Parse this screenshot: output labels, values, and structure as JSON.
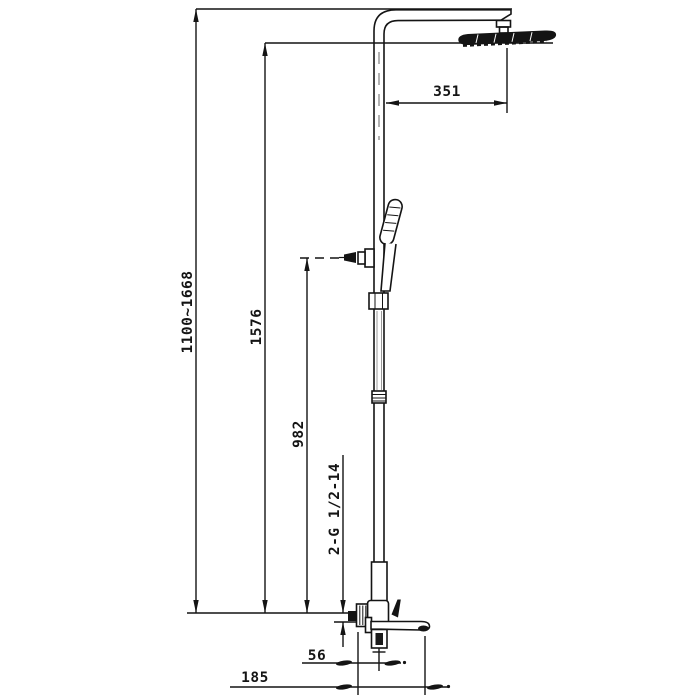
{
  "drawing": {
    "dimensions": {
      "overall_height": "1100~1668",
      "rain_head_height": "1576",
      "hand_shower_height": "982",
      "inlet_thread": "2-G 1/2-14",
      "arm_reach": "351",
      "wall_to_riser": "56",
      "wall_to_spout": "185"
    },
    "colors": {
      "line": "#141414",
      "background": "#ffffff"
    }
  }
}
